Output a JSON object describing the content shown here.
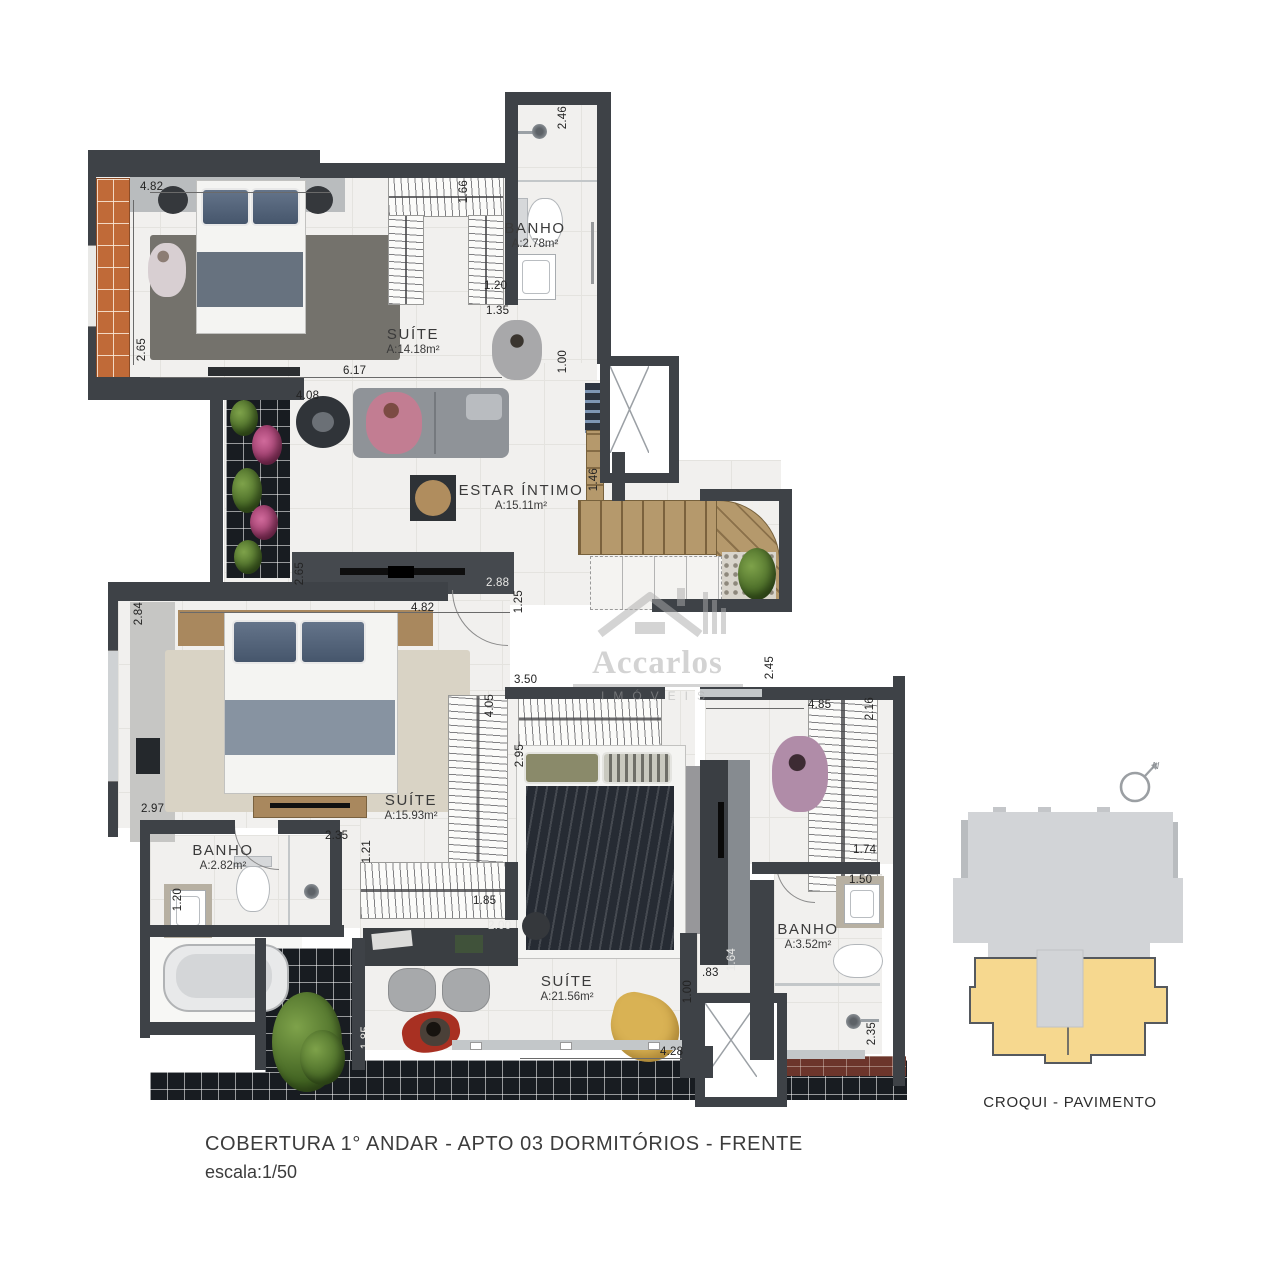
{
  "title": {
    "line1": "COBERTURA 1° ANDAR - APTO 03 DORMITÓRIOS - FRENTE",
    "line2": "escala:1/50"
  },
  "watermark": {
    "brand": "Accarlos",
    "sub": "IMÓVEIS"
  },
  "croqui": {
    "caption": "CROQUI - PAVIMENTO",
    "north": "N"
  },
  "rooms": {
    "suite1": {
      "name": "SUÍTE",
      "area": "A:14.18m²"
    },
    "banho1": {
      "name": "BANHO",
      "area": "A:2.78m²"
    },
    "estar": {
      "name": "ESTAR ÍNTIMO",
      "area": "A:15.11m²"
    },
    "suite2": {
      "name": "SUÍTE",
      "area": "A:15.93m²"
    },
    "banho2": {
      "name": "BANHO",
      "area": "A:2.82m²"
    },
    "suite3": {
      "name": "SUÍTE",
      "area": "A:21.56m²"
    },
    "banho3": {
      "name": "BANHO",
      "area": "A:3.52m²"
    }
  },
  "dims": {
    "suite1_width": "4.82",
    "suite1_height": "2.65",
    "suite1_bottom": "6.17",
    "closet1_height": "1.66",
    "banho1_sink": "1.20",
    "hall1": "1.35",
    "banho1_len": "2.46",
    "hall1_w": "1.00",
    "estar_top": "4.08",
    "stair_side": "1.46",
    "stair_right": "4.86",
    "estar_left": "2.65",
    "estar_tv": "2.88",
    "estar_bottom": "1.25",
    "suite2_top": "4.82",
    "suite2_left": "2.84",
    "suite2_left2": "2.97",
    "closet2_h": "4.05",
    "closet2_inner": "2.95",
    "closet3_top": "3.50",
    "banho2_top": "2.35",
    "closet2_bottom": "1.21",
    "closet2_bw": "1.85",
    "banho2_sink": "1.20",
    "suite3_table": "2.00",
    "hall3_w": ".83",
    "hall3_h": "1.00",
    "hall3_wall": "1.64",
    "suite3_bottom": "4.28",
    "banho3_shower": "2.35",
    "banho3_sink": "1.50",
    "dress_top": "4.85",
    "dress_closet": "2.16",
    "dress_closet_b": "1.74",
    "dress_right": "2.45",
    "terrace_left": "1.85"
  },
  "colors": {
    "wall": "#3e4247",
    "floor": "#f1f0ee",
    "wood": "#b5996c",
    "croqui_highlight": "#f6d88f",
    "croqui_gray": "#d2d4d7",
    "terrace_tile": "#181c21",
    "orange_tile": "#c06a38",
    "brick": "#6c352b"
  }
}
